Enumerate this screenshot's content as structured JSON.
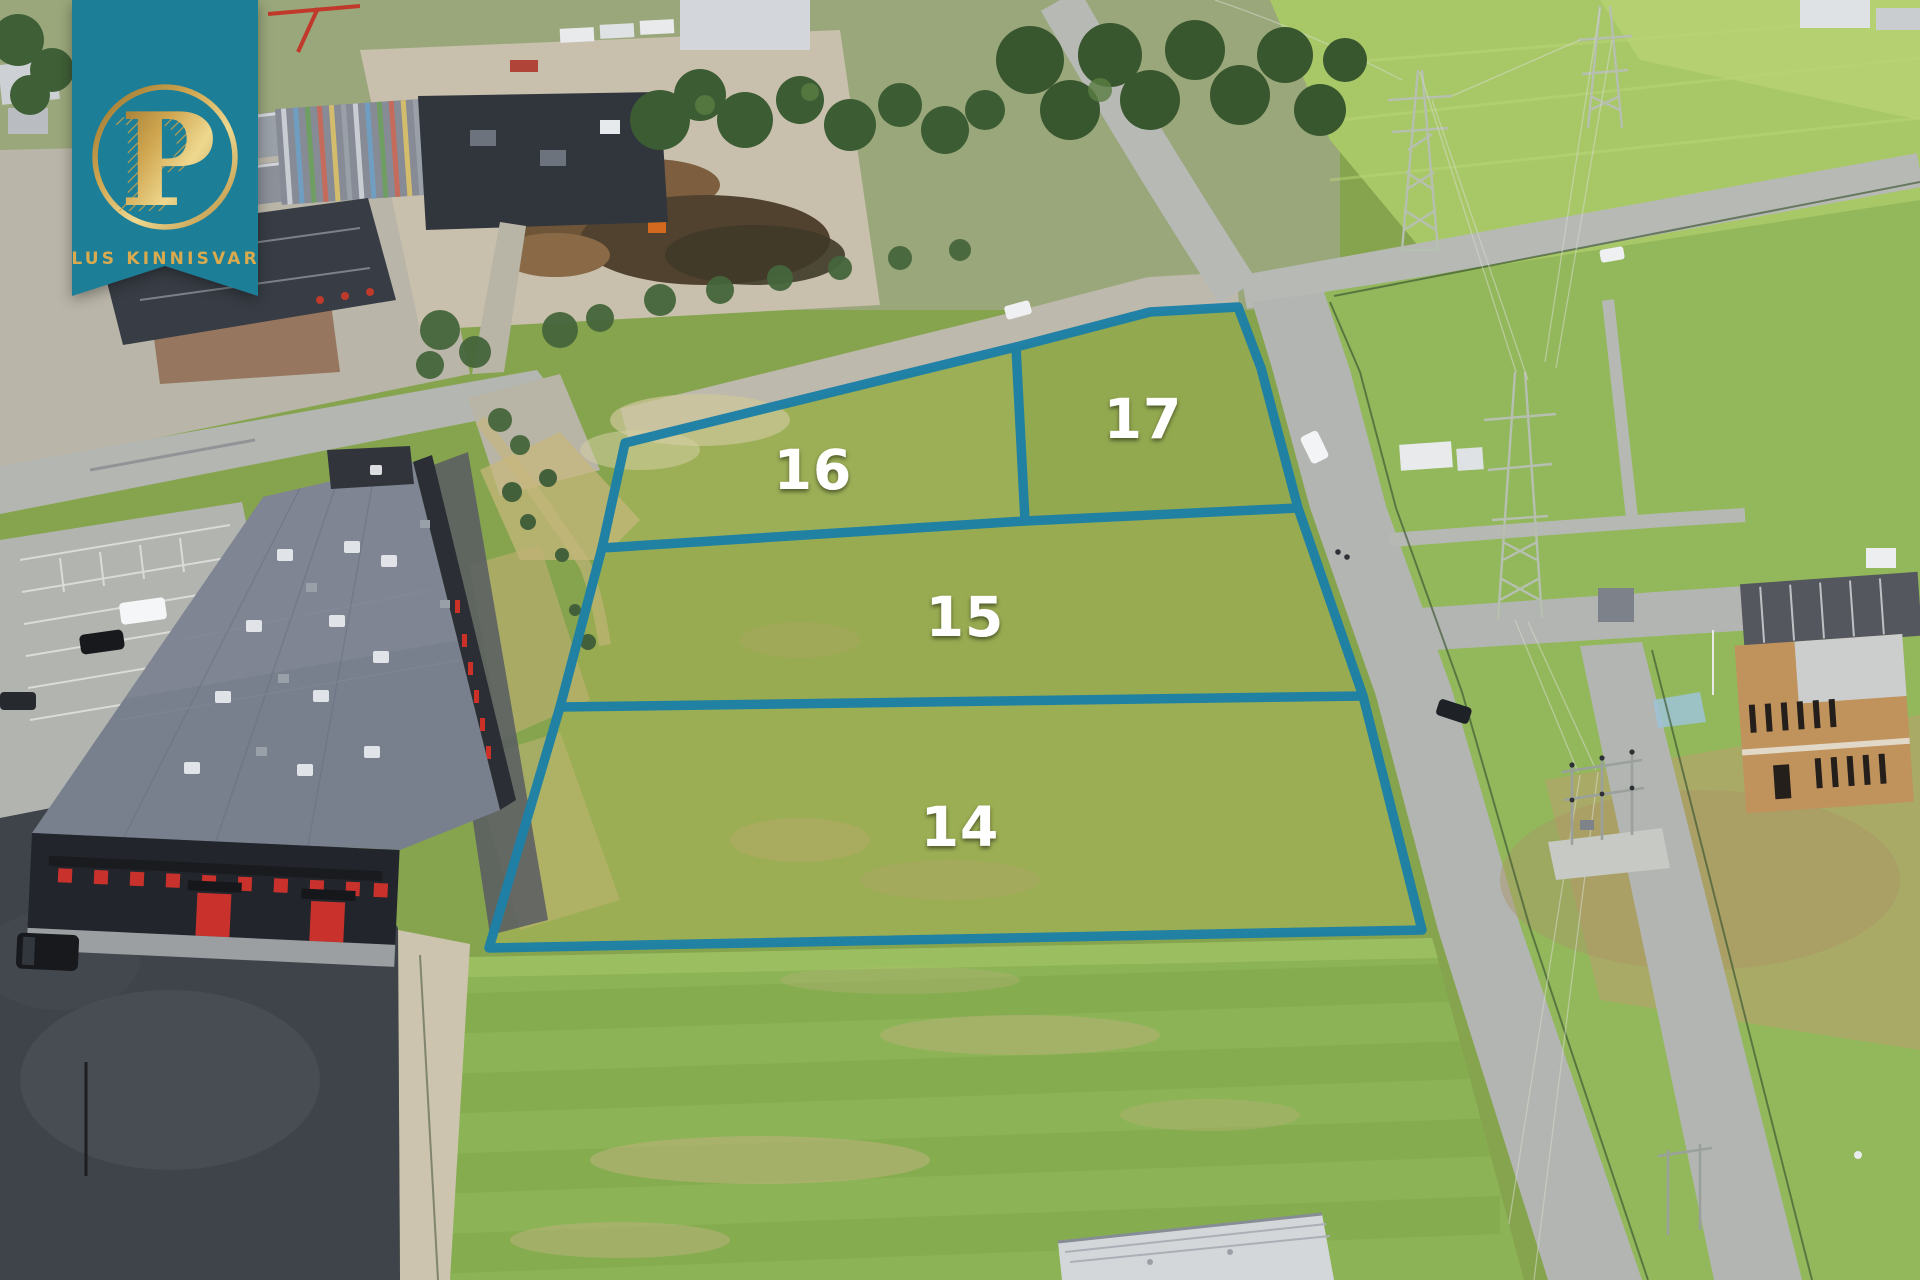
{
  "watermark": {
    "monogram": "P",
    "brand_text": "PLUS KINNISVARA",
    "banner_color": "#1c7e97",
    "text_gold": "#d9aa4e"
  },
  "plots": {
    "boundary_color": "#1d80a6",
    "label_color": "#ffffff",
    "items": [
      {
        "number": "14"
      },
      {
        "number": "15"
      },
      {
        "number": "16"
      },
      {
        "number": "17"
      }
    ]
  }
}
